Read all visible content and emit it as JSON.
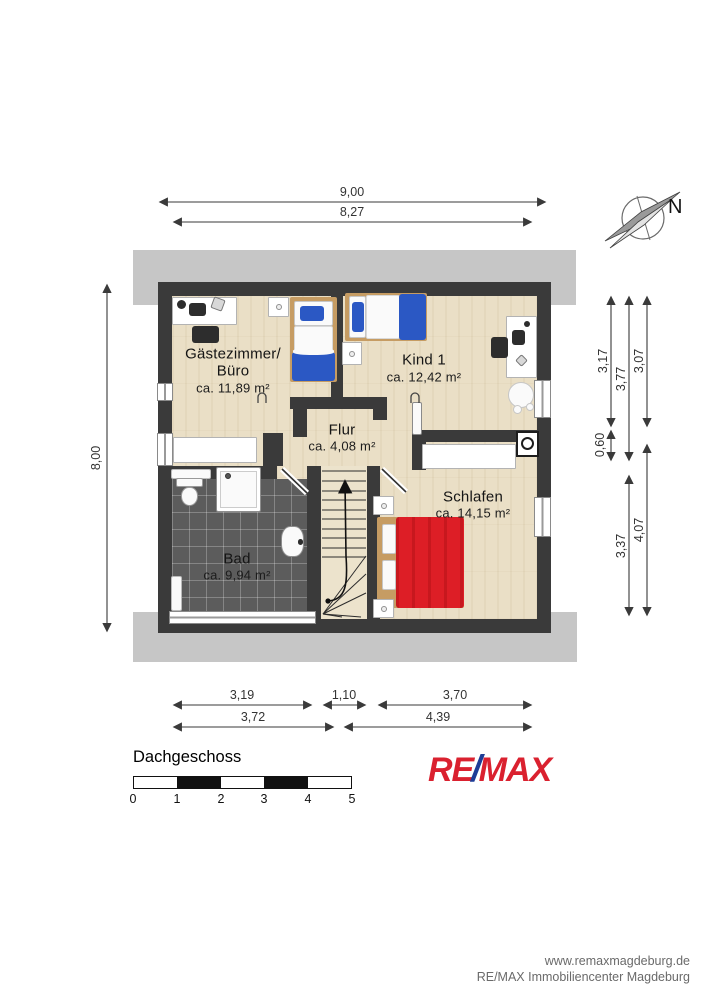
{
  "plan": {
    "floor_title": "Dachgeschoss",
    "compass": {
      "north": "N"
    },
    "rooms": [
      {
        "line1": "Gästezimmer/",
        "line2": "Büro",
        "area": "ca. 11,89 m²"
      },
      {
        "line1": "Kind 1",
        "area": "ca. 12,42 m²"
      },
      {
        "line1": "Flur",
        "area": "ca. 4,08 m²"
      },
      {
        "line1": "Schlafen",
        "area": "ca. 14,15 m²"
      },
      {
        "line1": "Bad",
        "area": "ca. 9,94 m²"
      }
    ],
    "dimensions": {
      "top": [
        "9,00",
        "8,27"
      ],
      "left": [
        "8,00"
      ],
      "right_col1": [
        "3,17",
        "0,60"
      ],
      "right_col2": [
        "3,77",
        "3,37"
      ],
      "right_col3": [
        "3,07",
        "4,07"
      ],
      "bottom_row1": [
        "3,19",
        "1,10",
        "3,70"
      ],
      "bottom_row2": [
        "3,72",
        "4,39"
      ]
    },
    "scalebar": {
      "ticks": [
        "0",
        "1",
        "2",
        "3",
        "4",
        "5"
      ]
    }
  },
  "branding": {
    "logo": {
      "re": "RE",
      "slash": "/",
      "max": "MAX"
    },
    "footer_line1": "www.remaxmagdeburg.de",
    "footer_line2": "RE/MAX Immobiliencenter Magdeburg",
    "colors": {
      "remax_red": "#da212f",
      "remax_blue": "#1d3c96"
    }
  },
  "style_colors": {
    "wall": "#3a3a3a",
    "roof_band": "#c6c6c6",
    "wood_floor": "#eadfc6",
    "bath_tile": "#5c5c5c",
    "bed_blue": "#2b58c4",
    "bed_red": "#dd1e26"
  }
}
